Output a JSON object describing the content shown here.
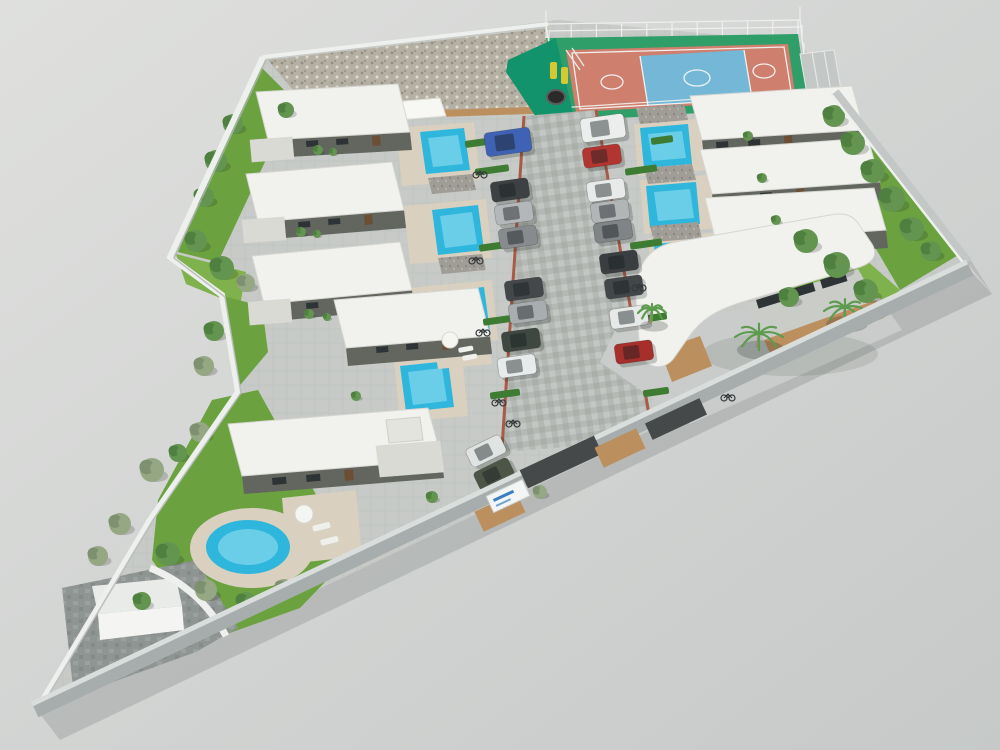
{
  "scene": {
    "title": "Aerial 3D architectural rendering of a gated villa community with central driveway, private pools, clubhouse, basketball court and playground",
    "counts": {
      "villas": 8,
      "rectangular_pools": 7,
      "round_pools": 1,
      "clubhouse": 1,
      "basketball_courts": 1,
      "playgrounds": 1,
      "parked_cars": 19,
      "palm_trees": 3,
      "bicycles": 8
    }
  },
  "colors": {
    "background_a": "#dfe0de",
    "background_b": "#c6c9c8",
    "site_paving": "#c7cac6",
    "paving_line": "#bcbfbb",
    "road_surface": "#b5b9b5",
    "road_stone_light": "#c3c7c3",
    "road_stone_dark": "#a8aca8",
    "road_edge_brick": "#a85a46",
    "roof_white": "#f1f1ee",
    "roof_edge": "#d6d6d2",
    "wall_dark": "#62665f",
    "annex_light": "#dadad5",
    "pool_water": "#2fb6dc",
    "pool_water_light": "#9ae2f2",
    "pool_deck": "#d9d0bf",
    "grass": "#6ba23f",
    "grass_light": "#7fb14c",
    "hedge": "#3f7c33",
    "tree_green": "#639551",
    "tree_dark": "#4f803f",
    "olive_green": "#95a783",
    "palm_frond": "#5d9b4e",
    "palm_trunk": "#9a8a6a",
    "court_green": "#2f9e68",
    "court_red": "#cf7f6d",
    "court_blue": "#74b7d6",
    "court_line": "#f4f6f4",
    "fence_white": "#f2f3f1",
    "playground_green": "#12936b",
    "play_yellow": "#d6c832",
    "play_black": "#2a2a2a",
    "gravel": "#b5b0a4",
    "gravel_dot": "#948f82",
    "gravel_dot2": "#ded9cc",
    "wood": "#bb8f5e",
    "wall_white": "#eef0ee",
    "wall_gray_band": "#a6adac",
    "wall_top_light": "#d9dedd",
    "wall_dark_panel": "#45494a",
    "stone_roof": "#a09c96",
    "sign_white": "#f4f6f5",
    "sign_blue": "#3a7fc1",
    "dark_paving": "#8f9593",
    "shadow": "#1d2422"
  },
  "cars": [
    {
      "x": 508,
      "y": 142,
      "angle": -8,
      "w": 46,
      "h": 24,
      "color": "#3f62b4",
      "name": "blue-suv"
    },
    {
      "x": 510,
      "y": 190,
      "angle": -8,
      "color": "#3d4143"
    },
    {
      "x": 514,
      "y": 213,
      "angle": -8,
      "color": "#b4b7b9"
    },
    {
      "x": 518,
      "y": 237,
      "angle": -8,
      "color": "#878b8d"
    },
    {
      "x": 524,
      "y": 289,
      "angle": -8,
      "color": "#44484a"
    },
    {
      "x": 528,
      "y": 312,
      "angle": -8,
      "color": "#a9adaf"
    },
    {
      "x": 521,
      "y": 340,
      "angle": -8,
      "color": "#3f4741"
    },
    {
      "x": 517,
      "y": 366,
      "angle": -8,
      "color": "#e8ebeb"
    },
    {
      "x": 603,
      "y": 128,
      "angle": -8,
      "w": 44,
      "h": 24,
      "color": "#eceeed",
      "name": "white-van"
    },
    {
      "x": 602,
      "y": 156,
      "angle": -8,
      "color": "#b23531"
    },
    {
      "x": 606,
      "y": 190,
      "angle": -8,
      "color": "#e7eae9"
    },
    {
      "x": 610,
      "y": 211,
      "angle": -8,
      "color": "#b2b5b6"
    },
    {
      "x": 613,
      "y": 231,
      "angle": -8,
      "color": "#808486"
    },
    {
      "x": 619,
      "y": 262,
      "angle": -8,
      "color": "#3a3e40"
    },
    {
      "x": 624,
      "y": 287,
      "angle": -8,
      "color": "#43474a"
    },
    {
      "x": 629,
      "y": 317,
      "angle": -8,
      "color": "#e6e9e8"
    },
    {
      "x": 634,
      "y": 352,
      "angle": -8,
      "color": "#a72f2b"
    },
    {
      "x": 486,
      "y": 451,
      "angle": -26,
      "color": "#dfe3e2"
    },
    {
      "x": 494,
      "y": 474,
      "angle": -26,
      "color": "#4d5547",
      "name": "olive-car"
    }
  ],
  "trees": [
    {
      "x": 834,
      "y": 116,
      "r": 11
    },
    {
      "x": 853,
      "y": 143,
      "r": 12
    },
    {
      "x": 873,
      "y": 171,
      "r": 12
    },
    {
      "x": 892,
      "y": 199,
      "r": 13
    },
    {
      "x": 912,
      "y": 229,
      "r": 12
    },
    {
      "x": 931,
      "y": 251,
      "r": 10
    },
    {
      "x": 806,
      "y": 241,
      "r": 12
    },
    {
      "x": 837,
      "y": 265,
      "r": 13
    },
    {
      "x": 866,
      "y": 291,
      "r": 12
    },
    {
      "x": 789,
      "y": 297,
      "r": 10
    },
    {
      "x": 233,
      "y": 124,
      "r": 10
    },
    {
      "x": 216,
      "y": 161,
      "r": 11
    },
    {
      "x": 204,
      "y": 197,
      "r": 10
    },
    {
      "x": 196,
      "y": 241,
      "r": 11
    },
    {
      "x": 222,
      "y": 268,
      "r": 12
    },
    {
      "x": 246,
      "y": 283,
      "r": 9,
      "kind": "olive"
    },
    {
      "x": 214,
      "y": 331,
      "r": 10
    },
    {
      "x": 204,
      "y": 366,
      "r": 10,
      "kind": "olive"
    },
    {
      "x": 152,
      "y": 470,
      "r": 12,
      "kind": "olive"
    },
    {
      "x": 120,
      "y": 524,
      "r": 11,
      "kind": "olive"
    },
    {
      "x": 98,
      "y": 556,
      "r": 10,
      "kind": "olive"
    },
    {
      "x": 168,
      "y": 554,
      "r": 12
    },
    {
      "x": 206,
      "y": 590,
      "r": 11,
      "kind": "olive"
    },
    {
      "x": 246,
      "y": 602,
      "r": 10
    },
    {
      "x": 284,
      "y": 588,
      "r": 9,
      "kind": "olive"
    },
    {
      "x": 142,
      "y": 601,
      "r": 9
    },
    {
      "x": 200,
      "y": 432,
      "r": 10,
      "kind": "olive"
    },
    {
      "x": 178,
      "y": 453,
      "r": 9
    },
    {
      "x": 286,
      "y": 110,
      "r": 8
    },
    {
      "x": 318,
      "y": 150,
      "r": 5
    },
    {
      "x": 333,
      "y": 152,
      "r": 4
    },
    {
      "x": 301,
      "y": 232,
      "r": 5
    },
    {
      "x": 317,
      "y": 234,
      "r": 4
    },
    {
      "x": 309,
      "y": 314,
      "r": 5
    },
    {
      "x": 327,
      "y": 317,
      "r": 4
    },
    {
      "x": 356,
      "y": 396,
      "r": 5
    },
    {
      "x": 748,
      "y": 136,
      "r": 5
    },
    {
      "x": 762,
      "y": 178,
      "r": 5
    },
    {
      "x": 776,
      "y": 220,
      "r": 5
    },
    {
      "x": 540,
      "y": 492,
      "r": 7,
      "kind": "olive"
    },
    {
      "x": 432,
      "y": 497,
      "r": 6
    }
  ],
  "palms": [
    {
      "x": 757,
      "y": 344,
      "r": 24
    },
    {
      "x": 843,
      "y": 318,
      "r": 21
    },
    {
      "x": 650,
      "y": 320,
      "r": 14
    }
  ],
  "hedges": [
    {
      "x": 492,
      "y": 170,
      "len": 34
    },
    {
      "x": 496,
      "y": 246,
      "len": 34
    },
    {
      "x": 500,
      "y": 320,
      "len": 34
    },
    {
      "x": 505,
      "y": 394,
      "len": 30
    },
    {
      "x": 641,
      "y": 170,
      "len": 32
    },
    {
      "x": 646,
      "y": 244,
      "len": 32
    },
    {
      "x": 651,
      "y": 318,
      "len": 32
    },
    {
      "x": 656,
      "y": 392,
      "len": 26
    },
    {
      "x": 476,
      "y": 143,
      "len": 22
    },
    {
      "x": 662,
      "y": 140,
      "len": 22
    }
  ],
  "bikes": [
    {
      "x": 480,
      "y": 175
    },
    {
      "x": 476,
      "y": 261
    },
    {
      "x": 483,
      "y": 333
    },
    {
      "x": 499,
      "y": 403
    },
    {
      "x": 513,
      "y": 424
    },
    {
      "x": 639,
      "y": 288
    },
    {
      "x": 728,
      "y": 398
    },
    {
      "x": 505,
      "y": 488
    }
  ]
}
